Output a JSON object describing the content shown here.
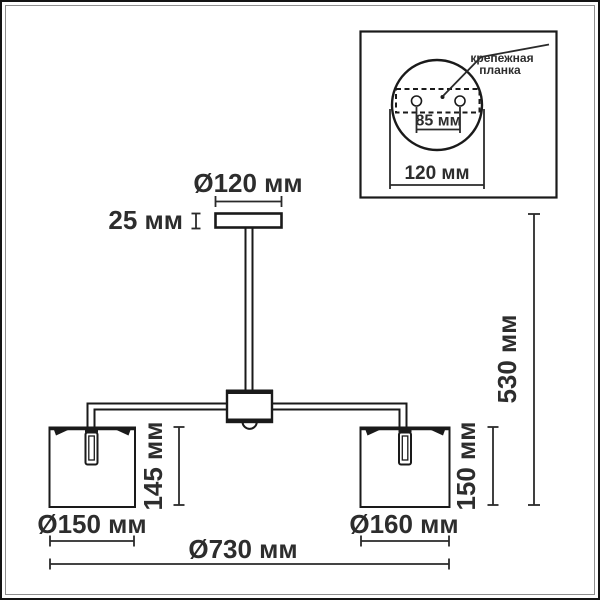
{
  "colors": {
    "line": "#1a1a1a",
    "text": "#2d2d2d",
    "frame": "#141414",
    "background": "#ffffff"
  },
  "main_diagram": {
    "canopy_diameter": "Ø120 мм",
    "canopy_height": "25 мм",
    "left_shade_height": "145 мм",
    "right_shade_height": "150 мм",
    "fixture_height": "530 мм",
    "left_shade_diameter": "Ø150 мм",
    "right_shade_diameter": "Ø160 мм",
    "fixture_width": "Ø730 мм"
  },
  "inset": {
    "callout": {
      "line1": "крепежная",
      "line2": "планка"
    },
    "hole_spacing": "85 мм",
    "plate_width": "120 мм"
  }
}
